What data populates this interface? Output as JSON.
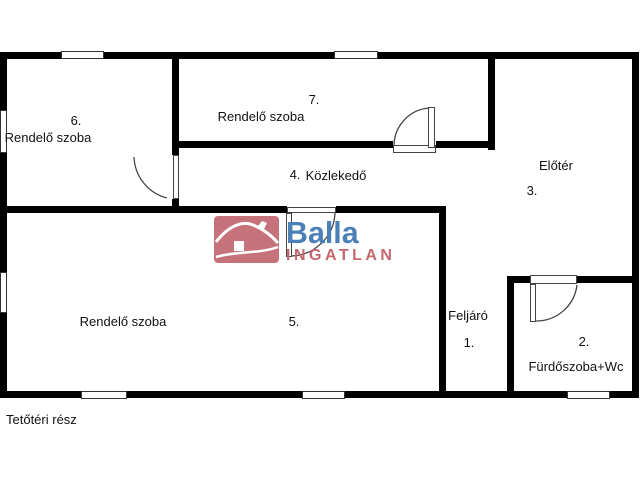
{
  "floorplan": {
    "rooms": [
      {
        "number": "1.",
        "name": "Feljáró"
      },
      {
        "number": "2.",
        "name": "Fürdőszoba+Wc"
      },
      {
        "number": "3.",
        "name": "Előtér"
      },
      {
        "number": "4.",
        "name": "Közlekedő"
      },
      {
        "number": "5.",
        "name": "Rendelő szoba"
      },
      {
        "number": "6.",
        "name": "Rendelő szoba"
      },
      {
        "number": "7.",
        "name": "Rendelő szoba"
      }
    ],
    "footer_note": "Tetőtéri rész"
  },
  "logo": {
    "brand": "Balla",
    "subbrand": "INGATLAN"
  },
  "colors": {
    "wall": "#000000",
    "label_text": "#111111",
    "logo_blue": "#4b80b6",
    "logo_red": "#c4676f",
    "logo_icon_background": "#c5727b"
  }
}
